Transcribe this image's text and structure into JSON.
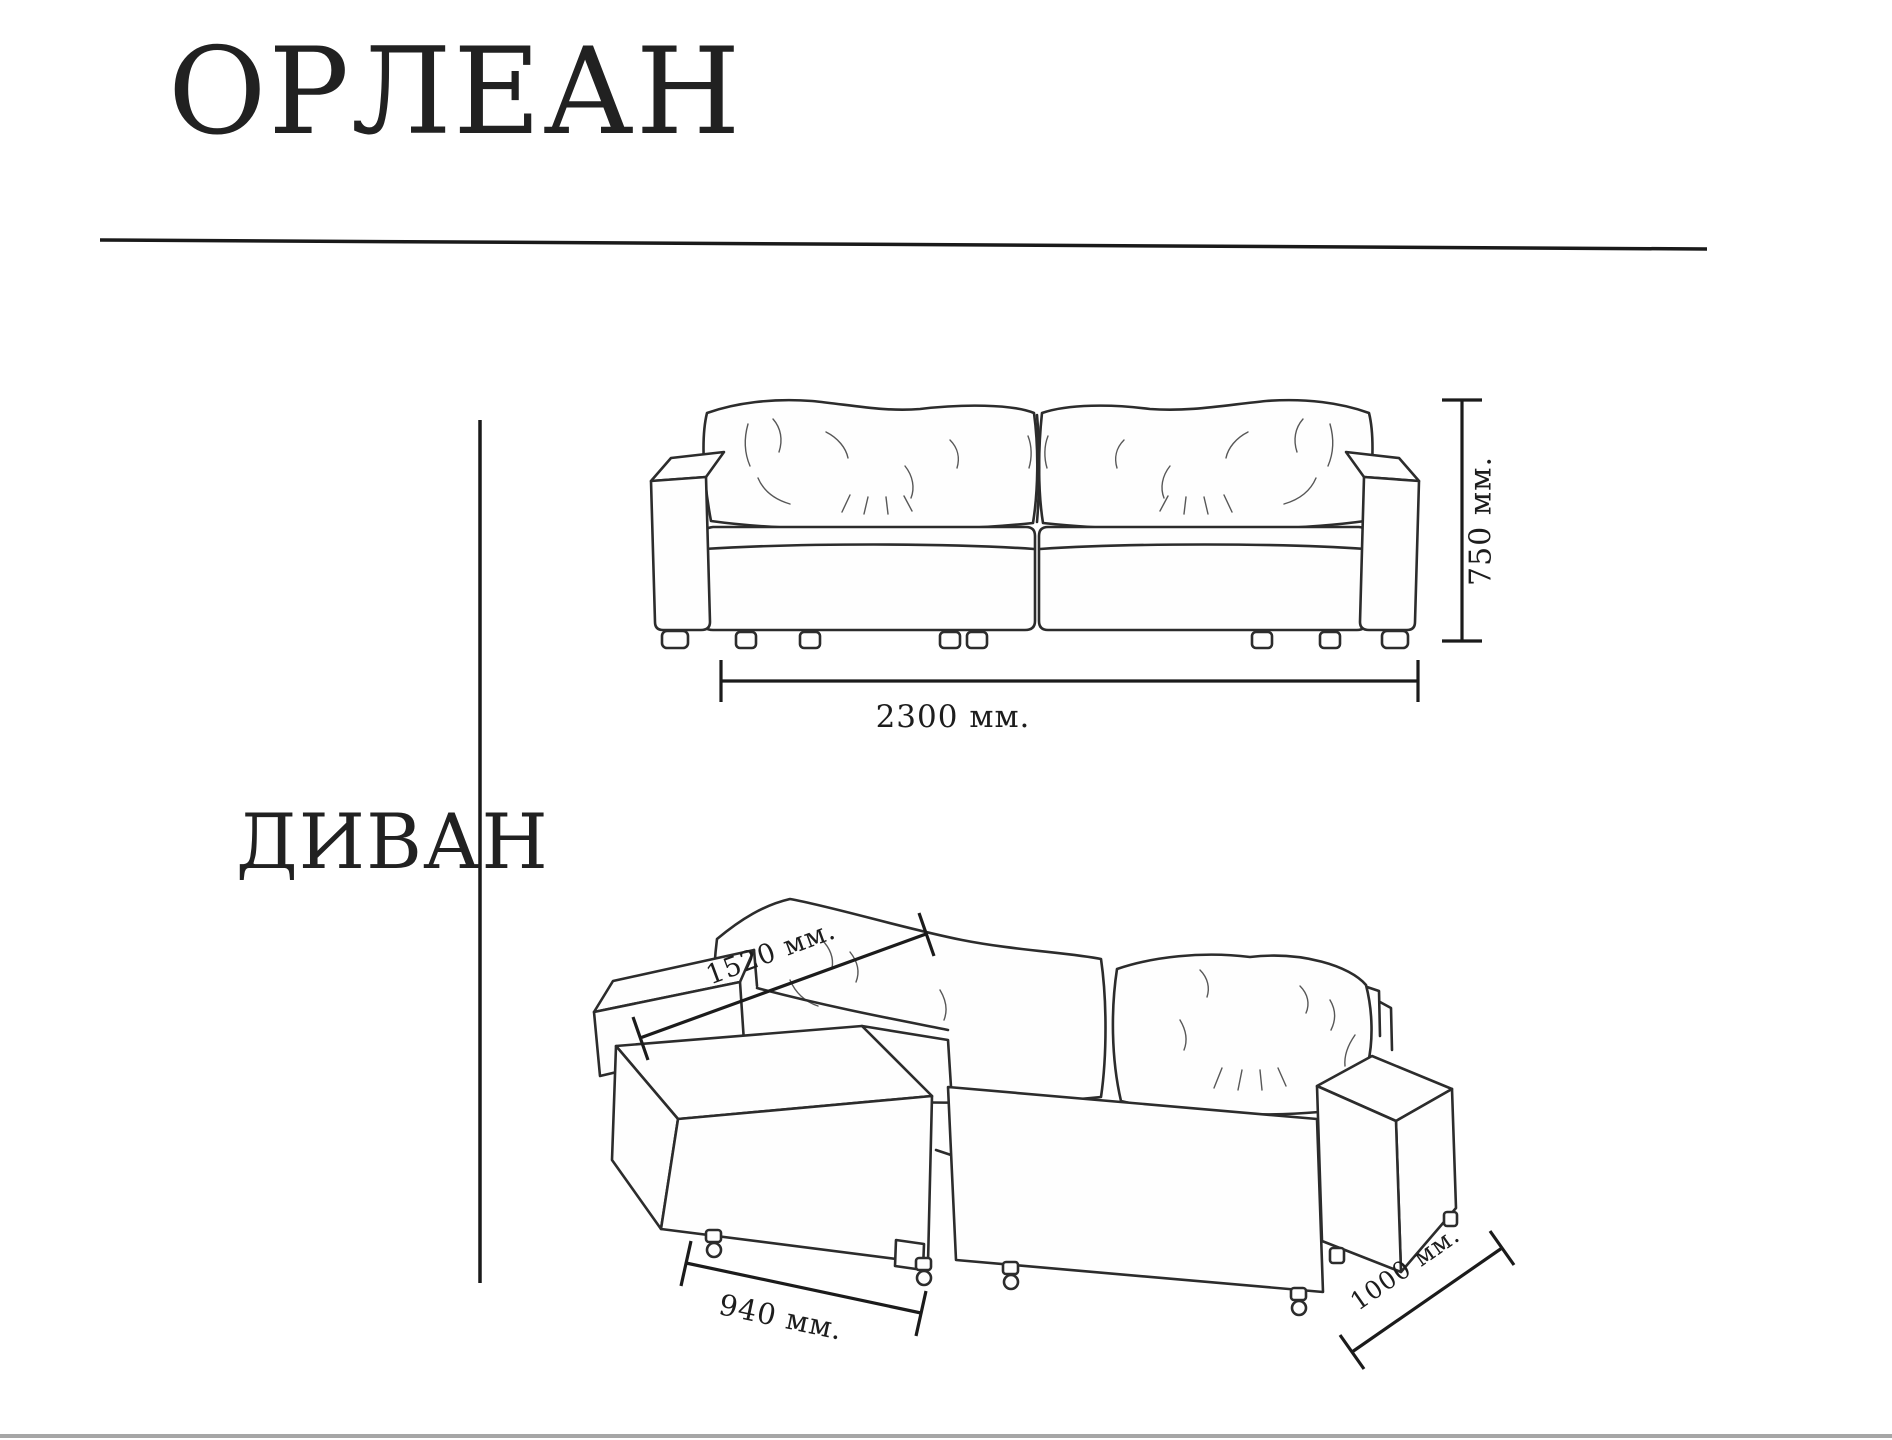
{
  "product": {
    "title": "ОРЛЕАН",
    "category_label": "ДИВАН"
  },
  "front_view": {
    "height_label": "750 мм.",
    "width_label": "2300 мм."
  },
  "unfolded_view": {
    "seat_depth_label": "1520 мм.",
    "ottoman_width_label": "940 мм.",
    "side_depth_label": "1000 мм."
  },
  "colors": {
    "ink": "#232323",
    "drawing_line": "#2c2c2c",
    "dimension_line": "#1b1b1b",
    "page_edge": "#a6a6a6",
    "background": "#ffffff"
  }
}
